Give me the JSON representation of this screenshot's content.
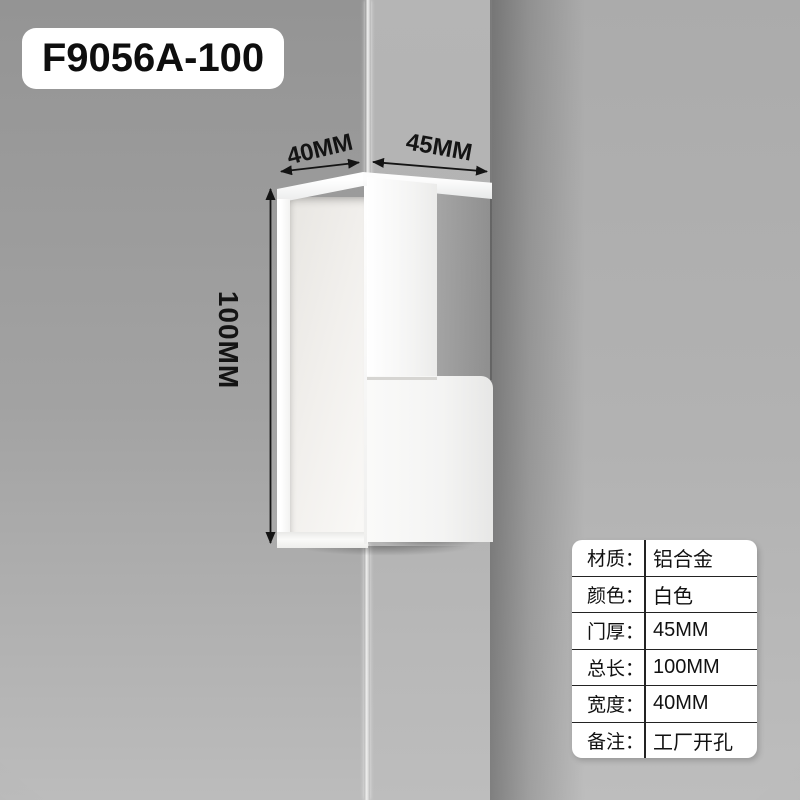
{
  "product": {
    "model_label": "F9056A-100"
  },
  "annotations": {
    "top_width": "40MM",
    "top_depth": "45MM",
    "side_height": "100MM"
  },
  "spec_table": {
    "rows": [
      {
        "label": "材质：",
        "value": "铝合金"
      },
      {
        "label": "颜色：",
        "value": "白色"
      },
      {
        "label": "门厚：",
        "value": "45MM"
      },
      {
        "label": "总长：",
        "value": "100MM"
      },
      {
        "label": "宽度：",
        "value": "40MM"
      },
      {
        "label": "备注：",
        "value": "工厂开孔"
      }
    ]
  },
  "colors": {
    "wall_gray": "#9a9a9a",
    "door_gray": "#b3b3b3",
    "edge_shadow": "#6f6f6f",
    "handle_white": "#f7f7f6",
    "annotation_black": "#141414",
    "card_white": "#ffffff",
    "table_line": "#232323"
  }
}
